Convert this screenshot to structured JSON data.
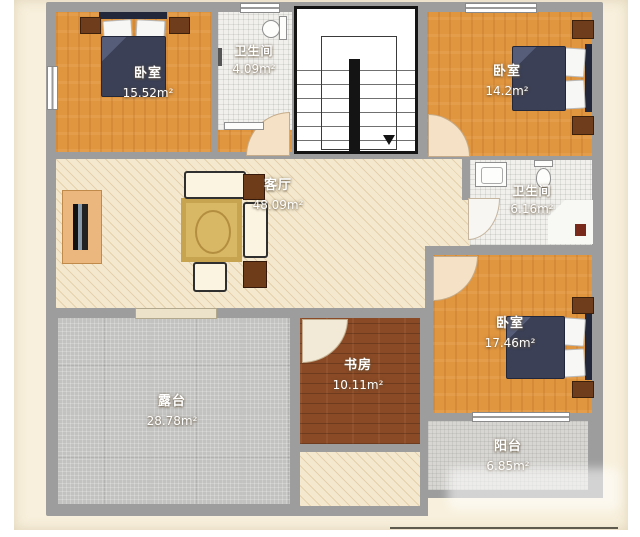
{
  "plan": {
    "type": "residential-floor-plan",
    "rooms": {
      "bedroom_top_left": {
        "name": "卧室",
        "area": "15.52m²"
      },
      "bathroom_top": {
        "name": "卫生间",
        "area": "4.09m²"
      },
      "bedroom_top_right": {
        "name": "卧室",
        "area": "14.2m²"
      },
      "living_room": {
        "name": "客厅",
        "area": "48.09m²"
      },
      "bathroom_right": {
        "name": "卫生间",
        "area": "6.16m²"
      },
      "bedroom_bottom_right": {
        "name": "卧室",
        "area": "17.46m²"
      },
      "study": {
        "name": "书房",
        "area": "10.11m²"
      },
      "terrace": {
        "name": "露台",
        "area": "28.78m²"
      },
      "balcony": {
        "name": "阳台",
        "area": "6.85m²"
      }
    },
    "colors": {
      "page_bg": "#f8f0dc",
      "wall": "#9d9d9d",
      "bedroom_floor": "#e0953f",
      "living_floor": "#f4e9cf",
      "bathroom_floor": "#f1f0ec",
      "terrace_floor": "#c2c2c0",
      "balcony_floor": "#d7d6d2",
      "study_floor": "#8a4a26",
      "bed_duvet": "#3b4056",
      "rug": "#d8b765",
      "furniture_dark": "#6f3d1c",
      "label_text": "#ffffff"
    }
  }
}
